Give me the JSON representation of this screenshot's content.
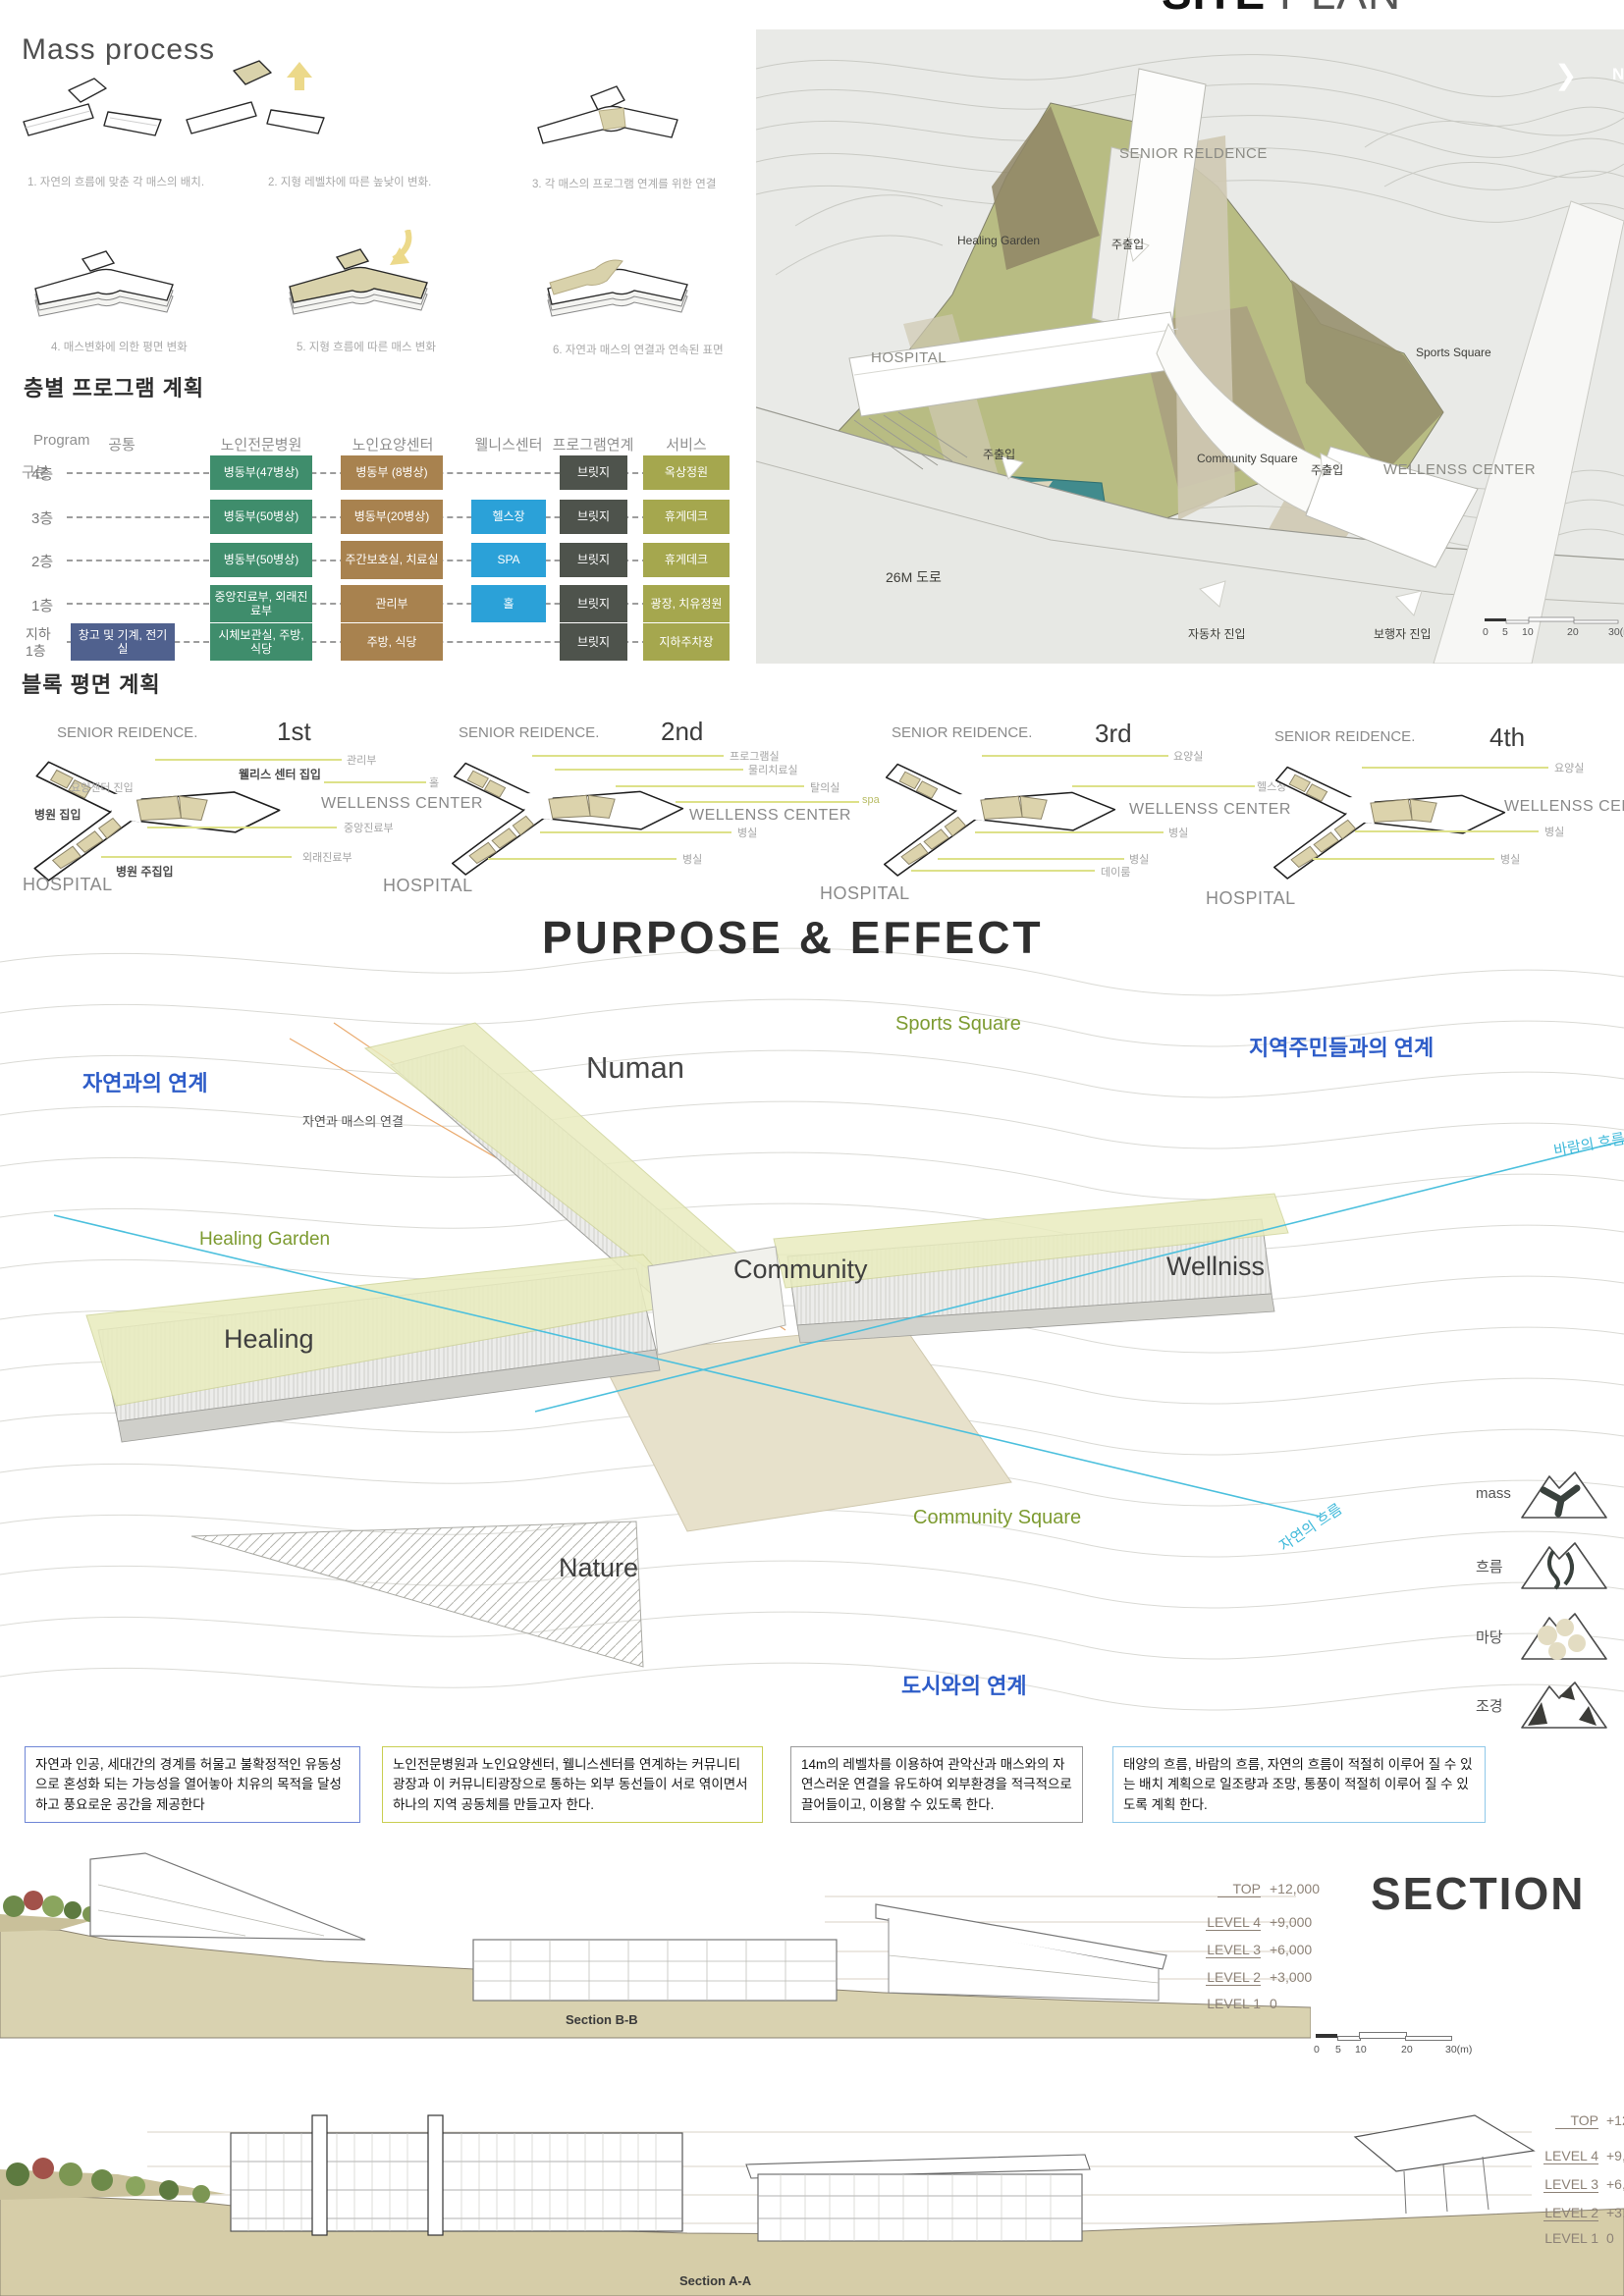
{
  "mass_process": {
    "title": "Mass process",
    "captions": [
      "1. 자연의 흐름에 맞춘 각 매스의 배치.",
      "2. 지형 레벨차에 따른 높낮이 변화.",
      "3. 각 매스의 프로그램 연계를 위한 연결",
      "4. 매스변화에 의한 평면 변화",
      "5. 지형 흐름에 따른 매스 변화",
      "6. 자연과 매스의 연결과 연속된 표면"
    ]
  },
  "program_plan": {
    "heading": "층별 프로그램 계획",
    "corner_top": "Program",
    "corner_bottom": "구분",
    "columns": [
      "공통",
      "노인전문병원",
      "노인요양센터",
      "웰니스센터",
      "프로그램연계",
      "서비스"
    ],
    "rows": [
      {
        "floor": "4층",
        "cells": {
          "hospital": "병동부(47병상)",
          "care": "병동부 (8병상)",
          "bridge": "브릿지",
          "service": "옥상정원"
        }
      },
      {
        "floor": "3층",
        "cells": {
          "hospital": "병동부(50병상)",
          "care": "병동부(20병상)",
          "wellness": "헬스장",
          "bridge": "브릿지",
          "service": "휴게데크"
        }
      },
      {
        "floor": "2층",
        "cells": {
          "hospital": "병동부(50병상)",
          "care": "주간보호실, 치료실",
          "wellness": "SPA",
          "bridge": "브릿지",
          "service": "휴게데크"
        }
      },
      {
        "floor": "1층",
        "cells": {
          "hospital": "중앙진료부, 외래진료부",
          "care": "관리부",
          "wellness": "홀",
          "bridge": "브릿지",
          "service": "광장, 치유정원"
        }
      },
      {
        "floor": "지하 1층",
        "cells": {
          "common": "창고 및 기계, 전기실",
          "hospital": "시체보관실, 주방, 식당",
          "care": "주방, 식당",
          "bridge": "브릿지",
          "service": "지하주차장"
        }
      }
    ]
  },
  "site_plan": {
    "title_site": "SITE",
    "title_plan": "PLAN",
    "compass_n": "N",
    "labels": {
      "senior": "SENIOR RELDENCE",
      "healing_garden": "Healing Garden",
      "entry1": "주출입",
      "hospital": "HOSPITAL",
      "sports_square": "Sports Square",
      "entry2": "주출입",
      "community_square": "Community Square",
      "entry3": "주출입",
      "wellness": "WELLENSS CENTER",
      "road": "26M 도로",
      "car_entry": "자동차 진입",
      "ped_entry": "보행자 진입"
    },
    "scale_ticks": [
      "0",
      "5",
      "10",
      "20",
      "30(m)"
    ]
  },
  "block_plan": {
    "heading": "블록 평면 계획",
    "plans": [
      {
        "senior": "SENIOR REIDENCE.",
        "floor": "1st",
        "wellness": "WELLENSS CENTER",
        "hospital": "HOSPITAL",
        "callouts": [
          "관리부",
          "웰리스 센터 집입",
          "홀",
          "요양센터 진입",
          "병원 집입",
          "중앙진료부",
          "외래진료부",
          "병원 주집입"
        ]
      },
      {
        "senior": "SENIOR REIDENCE.",
        "floor": "2nd",
        "wellness": "WELLENSS CENTER",
        "hospital": "HOSPITAL",
        "callouts": [
          "프로그램실",
          "물리치료실",
          "탈의실",
          "spa",
          "병실",
          "병실"
        ]
      },
      {
        "senior": "SENIOR REIDENCE.",
        "floor": "3rd",
        "wellness": "WELLENSS CENTER",
        "hospital": "HOSPITAL",
        "callouts": [
          "요양실",
          "헬스장",
          "병실",
          "병실",
          "데이룸"
        ]
      },
      {
        "senior": "SENIOR REIDENCE.",
        "floor": "4th",
        "wellness": "WELLENSS CENTER",
        "hospital": "HOSPITAL",
        "callouts": [
          "요양실",
          "병실",
          "병실"
        ]
      }
    ]
  },
  "purpose": {
    "title": "PURPOSE & EFFECT",
    "labels": {
      "sports_square": "Sports Square",
      "residents_link": "지역주민들과의 연계",
      "nature_link": "자연과의 연계",
      "numan": "Numan",
      "nature_mass": "자연과 매스의 연결",
      "wind_flow": "바람의 흐름",
      "healing_garden": "Healing Garden",
      "community": "Community",
      "wellniss": "Wellniss",
      "healing": "Healing",
      "community_square": "Community Square",
      "nature_flow": "자연의 흐름",
      "nature": "Nature",
      "city_link": "도시와의 연계"
    },
    "legend": [
      "mass",
      "흐름",
      "마당",
      "조경"
    ]
  },
  "notes": {
    "items": [
      {
        "text": "자연과 인공, 세대간의 경계를 허물고 불확정적인 유동성으로 혼성화 되는 가능성을 열어놓아 치유의 목적을 달성하고 풍요로운 공간을 제공한다"
      },
      {
        "text": "노인전문병원과 노인요양센터, 웰니스센터를 연계하는 커뮤니티 광장과 이 커뮤니티광장으로 통하는 외부 동선들이 서로 엮이면서 하나의 지역 공동체를 만들고자 한다."
      },
      {
        "text": "14m의 레벨차를 이용하여 관악산과 매스와의 자연스러운 연결을 유도하여 외부환경을 적극적으로 끌어들이고, 이용할 수 있도록 한다."
      },
      {
        "text": "태양의 흐름, 바람의 흐름, 자연의 흐름이 적절히 이루어 질 수 있는 배치 계획으로 일조량과 조망, 통풍이 적절히 이루어 질 수 있도록 계획 한다."
      }
    ]
  },
  "sections": {
    "title": "SECTION",
    "bb_label": "Section B-B",
    "aa_label": "Section A-A",
    "levels_bb": [
      {
        "name": "TOP",
        "value": "+12,000"
      },
      {
        "name": "LEVEL 4",
        "value": "+9,000"
      },
      {
        "name": "LEVEL 3",
        "value": "+6,000"
      },
      {
        "name": "LEVEL 2",
        "value": "+3,000"
      },
      {
        "name": "LEVEL 1",
        "value": "0"
      }
    ],
    "levels_aa": [
      {
        "name": "TOP",
        "value": "+12"
      },
      {
        "name": "LEVEL 4",
        "value": "+9,"
      },
      {
        "name": "LEVEL 3",
        "value": "+6,"
      },
      {
        "name": "LEVEL 2",
        "value": "+3,"
      },
      {
        "name": "LEVEL 1",
        "value": "0"
      }
    ],
    "scale_ticks": [
      "0",
      "5",
      "10",
      "20",
      "30(m)"
    ]
  }
}
